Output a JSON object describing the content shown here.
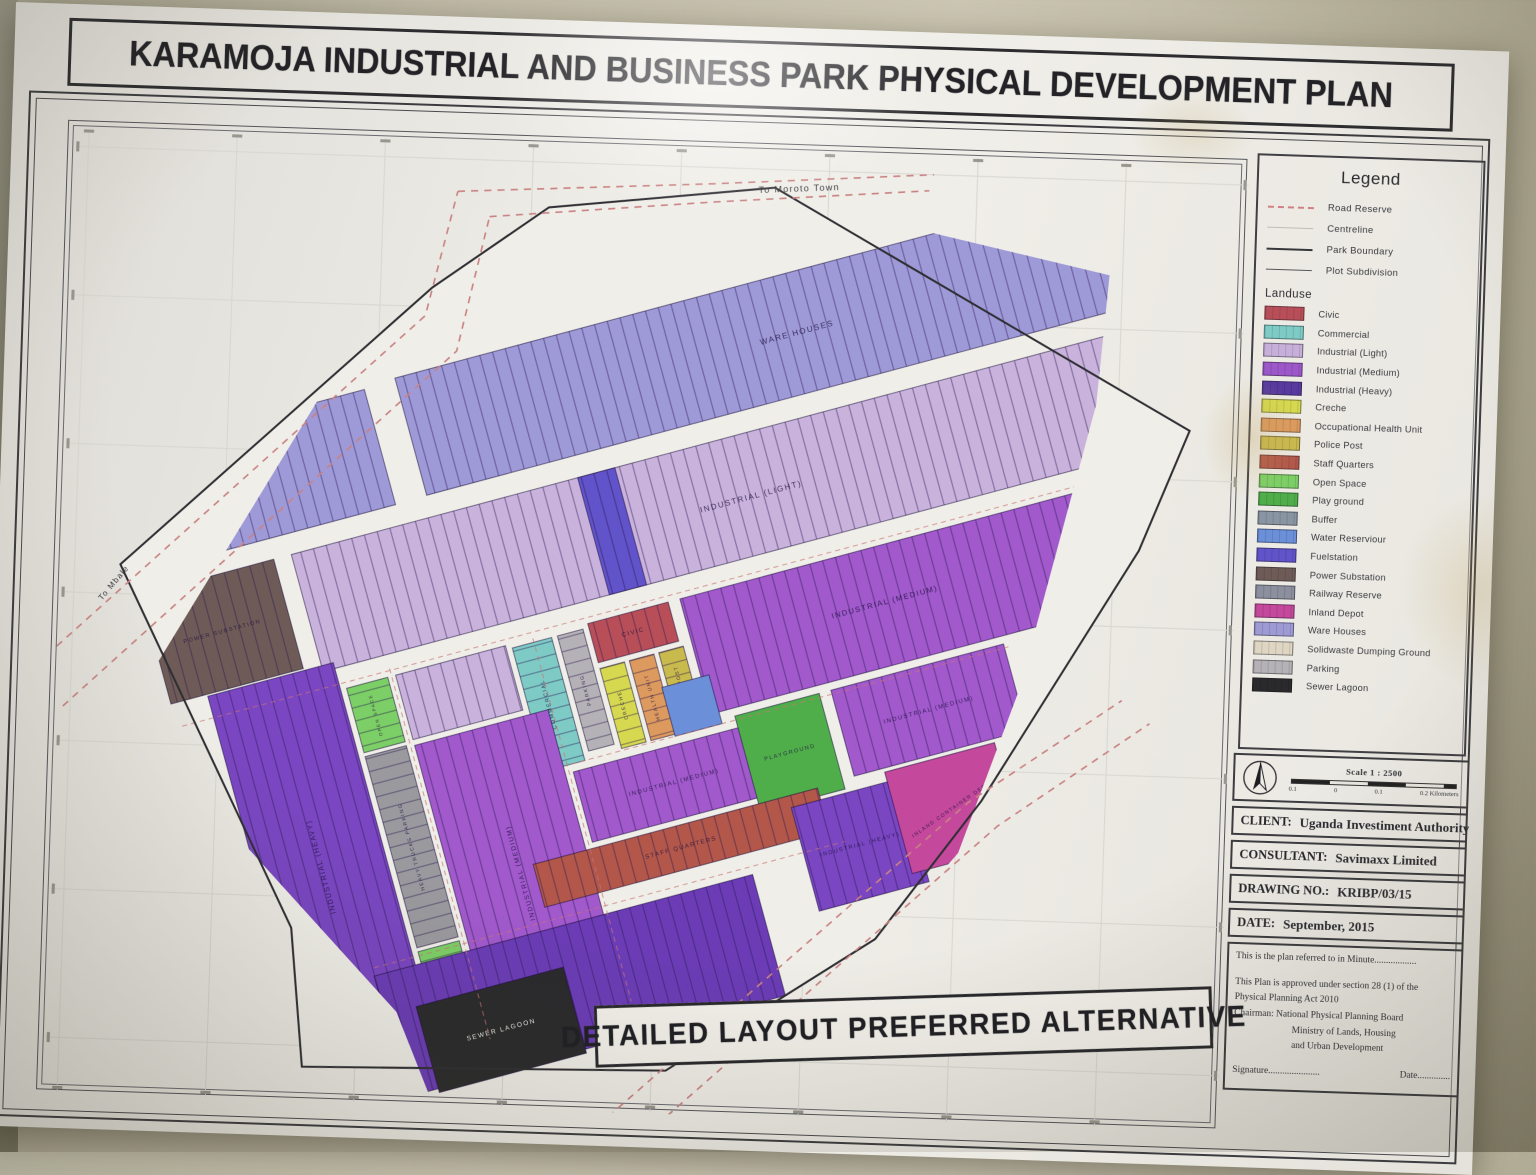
{
  "title": "KARAMOJA INDUSTRIAL AND BUSINESS PARK PHYSICAL DEVELOPMENT PLAN",
  "banner": "DETAILED LAYOUT PREFERRED ALTERNATIVE",
  "legend": {
    "title": "Legend",
    "line_items": [
      {
        "label": "Road Reserve",
        "style": "dashed-red"
      },
      {
        "label": "Centreline",
        "style": "faint"
      },
      {
        "label": "Park Boundary",
        "style": "solid-dark"
      },
      {
        "label": "Plot Subdivision",
        "style": "solid-thin"
      }
    ],
    "landuse_title": "Landuse",
    "landuse": [
      {
        "key": "civic",
        "label": "Civic",
        "color": "#b84f58"
      },
      {
        "key": "commercial",
        "label": "Commercial",
        "color": "#7ecbc6"
      },
      {
        "key": "industrial_light",
        "label": "Industrial (Light)",
        "color": "#c6b0d9"
      },
      {
        "key": "industrial_medium",
        "label": "Industrial (Medium)",
        "color": "#9c57c9"
      },
      {
        "key": "industrial_heavy",
        "label": "Industrial (Heavy)",
        "color": "#57399f"
      },
      {
        "key": "creche",
        "label": "Creche",
        "color": "#d6d94f"
      },
      {
        "key": "health",
        "label": "Occupational Health Unit",
        "color": "#dd9a5f"
      },
      {
        "key": "police",
        "label": "Police Post",
        "color": "#c9ba4e"
      },
      {
        "key": "staff_quarters",
        "label": "Staff Quarters",
        "color": "#b2574a"
      },
      {
        "key": "open_space",
        "label": "Open Space",
        "color": "#7ccf66"
      },
      {
        "key": "play_ground",
        "label": "Play ground",
        "color": "#4fae4a"
      },
      {
        "key": "buffer",
        "label": "Buffer",
        "color": "#8a95a3"
      },
      {
        "key": "water",
        "label": "Water Reserviour",
        "color": "#6b8fd8"
      },
      {
        "key": "fuel",
        "label": "Fuelstation",
        "color": "#6153c9"
      },
      {
        "key": "power",
        "label": "Power Substation",
        "color": "#6e5b57"
      },
      {
        "key": "railway",
        "label": "Railway Reserve",
        "color": "#8b8f9e"
      },
      {
        "key": "inland",
        "label": "Inland Depot",
        "color": "#c4489c"
      },
      {
        "key": "ware_houses",
        "label": "Ware Houses",
        "color": "#9e9ad4"
      },
      {
        "key": "solidwaste",
        "label": "Solidwaste Dumping Ground",
        "color": "#ded6c2"
      },
      {
        "key": "parking",
        "label": "Parking",
        "color": "#b4b2b6"
      },
      {
        "key": "sewer",
        "label": "Sewer Lagoon",
        "color": "#2a2a2c"
      }
    ]
  },
  "titleblock": {
    "scale_label": "Scale 1 : 2500",
    "scalebar_ticks": [
      "0.1",
      "0",
      "0.1",
      "0.2 Kilometers"
    ],
    "rows": [
      {
        "label": "CLIENT:",
        "value": "Uganda Investiment Authority"
      },
      {
        "label": "CONSULTANT:",
        "value": "Savimaxx Limited"
      },
      {
        "label": "DRAWING NO.:",
        "value": "KRIBP/03/15"
      },
      {
        "label": "DATE:",
        "value": "September, 2015"
      }
    ],
    "notes": [
      {
        "text": "This is the plan referred to in Minute..................",
        "indent": 0,
        "gap_after": true
      },
      {
        "text": "This Plan is approved under section 28 (1) of the",
        "indent": 0,
        "gap_after": false
      },
      {
        "text": "Physical Planning Act 2010",
        "indent": 0,
        "gap_after": false
      },
      {
        "text": "Chairman:    National Physical Planning Board",
        "indent": 0,
        "gap_after": false
      },
      {
        "text": "Ministry of Lands, Housing",
        "indent": 58,
        "gap_after": false
      },
      {
        "text": "and Urban Development",
        "indent": 58,
        "gap_after": false
      }
    ],
    "signature_label": "Signature......................",
    "date_label": "Date.............."
  },
  "map": {
    "rotation": {
      "angle": -17,
      "cx": 650,
      "cy": 590
    },
    "boundary": [
      [
        560,
        185
      ],
      [
        782,
        158
      ],
      [
        1198,
        385
      ],
      [
        1152,
        505
      ],
      [
        1005,
        758
      ],
      [
        905,
        898
      ],
      [
        703,
        1035
      ],
      [
        345,
        1043
      ],
      [
        330,
        906
      ],
      [
        150,
        552
      ],
      [
        448,
        268
      ]
    ],
    "base_color": "#efeee8",
    "road_labels": [
      {
        "text": "To Moroto Town",
        "x": 806,
        "y": 161,
        "rot": -4,
        "size": 9
      },
      {
        "text": "To Mbale",
        "x": 146,
        "y": 572,
        "rot": -52,
        "size": 8
      }
    ],
    "roads": [
      {
        "name": "nw-road-edge-1",
        "points": [
          [
            62,
            662
          ],
          [
            442,
            296
          ],
          [
            470,
            172
          ]
        ]
      },
      {
        "name": "nw-road-edge-2",
        "points": [
          [
            98,
            694
          ],
          [
            474,
            330
          ],
          [
            502,
            196
          ]
        ]
      },
      {
        "name": "moroto-road-edge-1",
        "points": [
          [
            470,
            172
          ],
          [
            724,
            156
          ],
          [
            938,
            140
          ]
        ]
      },
      {
        "name": "moroto-road-edge-2",
        "points": [
          [
            502,
            196
          ],
          [
            724,
            174
          ],
          [
            934,
            156
          ]
        ]
      },
      {
        "name": "se-road-edge-1",
        "points": [
          [
            640,
            1142
          ],
          [
            1022,
            782
          ],
          [
            1168,
            676
          ]
        ]
      },
      {
        "name": "se-road-edge-2",
        "points": [
          [
            610,
            1118
          ],
          [
            992,
            760
          ],
          [
            1140,
            654
          ]
        ]
      }
    ],
    "inner_dashed": [
      [
        200,
        578,
        1240,
        578
      ],
      [
        560,
        714,
        1010,
        714
      ],
      [
        320,
        858,
        800,
        858
      ],
      [
        412,
        576,
        412,
        956
      ],
      [
        556,
        584,
        556,
        956
      ]
    ],
    "regions": [
      {
        "name": "ware-house-left",
        "landuse": "ware_houses",
        "color": "#9e9ad8",
        "rect": [
          150,
          303,
          310,
          118
        ],
        "label": "WARE HOUSE",
        "rot": 0,
        "size": 7
      },
      {
        "name": "ware-houses-top",
        "landuse": "ware_houses",
        "color": "#9e9ad8",
        "rect": [
          492,
          300,
          788,
          120
        ],
        "label": "WARE HOUSES",
        "rot": 0,
        "size": 8
      },
      {
        "name": "power-substation",
        "landuse": "power",
        "rect": [
          195,
          442,
          135,
          112
        ],
        "label": "POWER SUBSTATION",
        "rot": 0,
        "size": 5.5
      },
      {
        "name": "industrial-light-upper",
        "landuse": "industrial_light",
        "color": "#c9b3dc",
        "rect": [
          348,
          442,
          892,
          120
        ],
        "label": "INDUSTRIAL (LIGHT)",
        "rot": 0,
        "size": 8,
        "label_at": [
          800,
          505
        ]
      },
      {
        "name": "fuel-station-plot",
        "landuse": "fuel",
        "rect": [
          640,
          442,
          38,
          120
        ],
        "label": "",
        "rot": 0,
        "size": 5
      },
      {
        "name": "industrial-light-mid",
        "landuse": "industrial_light",
        "color": "#c9b3dc",
        "rect": [
          416,
          584,
          112,
          66
        ],
        "label": "",
        "rot": 0,
        "size": 6
      },
      {
        "name": "commercial-strip",
        "landuse": "commercial",
        "rect": [
          534,
          588,
          40,
          126
        ],
        "label": "COMMERCIAL",
        "rot": -90,
        "size": 5.5,
        "pattern": "h"
      },
      {
        "name": "parking-strip",
        "landuse": "parking",
        "rect": [
          580,
          588,
          26,
          118
        ],
        "label": "PARKING",
        "rot": -90,
        "size": 5,
        "pattern": "h"
      },
      {
        "name": "civic-block",
        "landuse": "civic",
        "rect": [
          612,
          584,
          82,
          40
        ],
        "label": "CIVIC",
        "rot": 0,
        "size": 6
      },
      {
        "name": "creche-block",
        "landuse": "creche",
        "rect": [
          612,
          630,
          25,
          82
        ],
        "label": "CRECHE",
        "rot": -90,
        "size": 5,
        "pattern": "h"
      },
      {
        "name": "health-unit-block",
        "landuse": "health",
        "rect": [
          642,
          630,
          25,
          82
        ],
        "label": "HEALTH UNIT",
        "rot": -90,
        "size": 5,
        "pattern": "h"
      },
      {
        "name": "police-post-block",
        "landuse": "police",
        "rect": [
          672,
          630,
          25,
          82
        ],
        "label": "POLICE POST",
        "rot": -90,
        "size": 5,
        "pattern": "h"
      },
      {
        "name": "industrial-medium-right",
        "landuse": "industrial_medium",
        "color": "#a159cc",
        "rect": [
          706,
          584,
          534,
          118
        ],
        "label": "INDUSTRIAL (MEDIUM)",
        "rot": 0,
        "size": 7.5,
        "label_at": [
          900,
          640
        ]
      },
      {
        "name": "industrial-heavy-left",
        "landuse": "industrial_heavy",
        "color": "#7a46c2",
        "rect": [
          232,
          556,
          128,
          384
        ],
        "label": "INDUSTRIAL (HEAVY)",
        "rot": -90,
        "size": 7
      },
      {
        "name": "open-space-top",
        "landuse": "open_space",
        "rect": [
          366,
          584,
          42,
          66
        ],
        "label": "OPEN SPACE",
        "rot": -90,
        "size": 4.5,
        "pattern": "h"
      },
      {
        "name": "heavy-trucks-parking",
        "landuse": "parking",
        "color": "#9a999e",
        "rect": [
          366,
          654,
          42,
          196
        ],
        "label": "HEAVY TRUCKS PARKING",
        "rot": -90,
        "size": 5,
        "pattern": "h"
      },
      {
        "name": "open-space-bottom",
        "landuse": "open_space",
        "rect": [
          366,
          854,
          42,
          100
        ],
        "label": "OPEN SPACE",
        "rot": -90,
        "size": 4.5,
        "pattern": "h"
      },
      {
        "name": "industrial-medium-central",
        "landuse": "industrial_medium",
        "color": "#a159cc",
        "rect": [
          416,
          656,
          136,
          298
        ],
        "label": "INDUSTRIAL (MEDIUM)",
        "rot": -90,
        "size": 6.5
      },
      {
        "name": "industrial-medium-mid",
        "landuse": "industrial_medium",
        "color": "#a159cc",
        "rect": [
          560,
          722,
          186,
          72
        ],
        "label": "INDUSTRIAL (MEDIUM)",
        "rot": 0,
        "size": 6
      },
      {
        "name": "water-reservoir-plot",
        "landuse": "water",
        "rect": [
          666,
          664,
          48,
          50
        ],
        "label": "",
        "rot": 0,
        "size": 5,
        "pattern": "none"
      },
      {
        "name": "playground-block",
        "landuse": "play_ground",
        "rect": [
          728,
          710,
          86,
          98
        ],
        "label": "PLAYGROUND",
        "rot": 0,
        "size": 5.5,
        "pattern": "none"
      },
      {
        "name": "industrial-medium-right2",
        "landuse": "industrial_medium",
        "color": "#a159cc",
        "rect": [
          826,
          710,
          176,
          88
        ],
        "label": "INDUSTRIAL (MEDIUM)",
        "rot": 0,
        "size": 6
      },
      {
        "name": "staff-quarters-band",
        "landuse": "staff_quarters",
        "rect": [
          498,
          800,
          290,
          44
        ],
        "label": "STAFF QUARTERS",
        "rot": 0,
        "size": 6
      },
      {
        "name": "industrial-heavy-right",
        "landuse": "industrial_heavy",
        "color": "#7a46c2",
        "rect": [
          758,
          812,
          112,
          106
        ],
        "label": "INDUSTRIAL (HEAVY)",
        "rot": 0,
        "size": 5.5
      },
      {
        "name": "inland-container-depot",
        "landuse": "inland",
        "rect": [
          856,
          802,
          112,
          104
        ],
        "label": "INLAND CONTAINER DEPOT",
        "rot": -20,
        "size": 5,
        "pattern": "none"
      },
      {
        "name": "industrial-heavy-bottom",
        "landuse": "industrial_heavy",
        "color": "#6b3cb6",
        "rect": [
          318,
          866,
          386,
          124
        ],
        "label": "INDUSTRIAL (HEAVY)",
        "rot": 0,
        "size": 7,
        "label_at": [
          420,
          930
        ]
      },
      {
        "name": "sewer-lagoon",
        "landuse": "sewer",
        "rect": [
          350,
          906,
          150,
          88
        ],
        "label": "SEWER LAGOON",
        "rot": 0,
        "size": 6.5,
        "pattern": "none",
        "label_fill": "#e9e7e1"
      },
      {
        "name": "waste-collection-site",
        "landuse": "solidwaste",
        "rect": [
          238,
          840,
          54,
          152
        ],
        "label": "WASTE COLLECTION SITE",
        "rot": -90,
        "size": 5,
        "pattern": "h"
      }
    ]
  }
}
